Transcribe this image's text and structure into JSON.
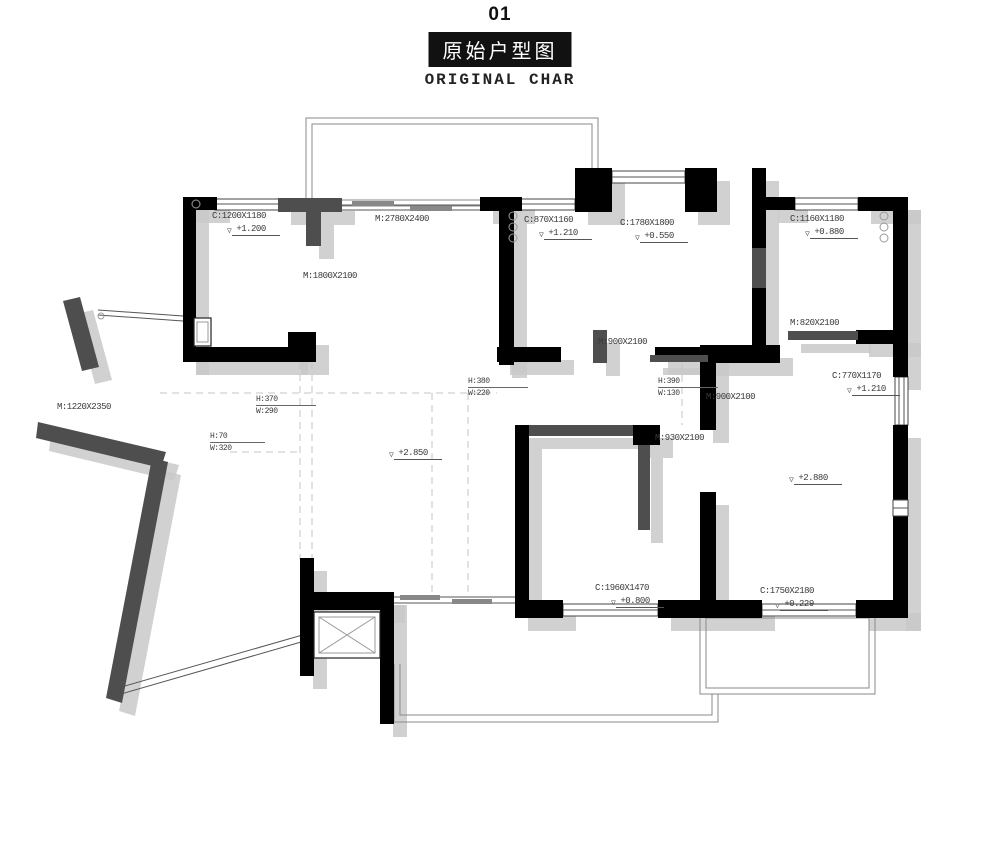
{
  "header": {
    "index": "01",
    "title_cn": "原始户型图",
    "title_en": "ORIGINAL CHAR"
  },
  "colors": {
    "wall": "#000000",
    "wall_secondary": "#4e4e4e",
    "shadow": "#c9c9c9",
    "thin_line": "#8a8a8a",
    "text": "#3a3a3a",
    "title_bg": "#111111"
  },
  "plan": {
    "labels": [
      {
        "type": "plain",
        "text": "C:1200X1180",
        "x": 212,
        "y": 211
      },
      {
        "type": "level",
        "text": "+1.200",
        "x": 228,
        "y": 224
      },
      {
        "type": "plain",
        "text": "M:2780X2400",
        "x": 375,
        "y": 214
      },
      {
        "type": "plain",
        "text": "M:1800X2100",
        "x": 303,
        "y": 271
      },
      {
        "type": "plain",
        "text": "C:870X1160",
        "x": 524,
        "y": 215
      },
      {
        "type": "level",
        "text": "+1.210",
        "x": 540,
        "y": 228
      },
      {
        "type": "plain",
        "text": "C:1780X1800",
        "x": 620,
        "y": 218
      },
      {
        "type": "level",
        "text": "+0.550",
        "x": 636,
        "y": 231
      },
      {
        "type": "plain",
        "text": "C:1160X1180",
        "x": 790,
        "y": 214
      },
      {
        "type": "level",
        "text": "+0.880",
        "x": 806,
        "y": 227
      },
      {
        "type": "plain",
        "text": "M:820X2100",
        "x": 790,
        "y": 318
      },
      {
        "type": "plain",
        "text": "M:900X2100",
        "x": 598,
        "y": 337
      },
      {
        "type": "frac",
        "top": "H:380",
        "bottom": "W:220",
        "x": 468,
        "y": 377
      },
      {
        "type": "frac",
        "top": "H:390",
        "bottom": "W:130",
        "x": 658,
        "y": 377
      },
      {
        "type": "plain",
        "text": "M:900X2100",
        "x": 706,
        "y": 392
      },
      {
        "type": "plain",
        "text": "C:770X1170",
        "x": 832,
        "y": 371
      },
      {
        "type": "level",
        "text": "+1.210",
        "x": 848,
        "y": 384
      },
      {
        "type": "plain",
        "text": "M:1220X2350",
        "x": 57,
        "y": 402
      },
      {
        "type": "frac",
        "top": "H:370",
        "bottom": "W:290",
        "x": 256,
        "y": 395
      },
      {
        "type": "frac",
        "top": "H:70",
        "bottom": "W:320",
        "x": 210,
        "y": 432
      },
      {
        "type": "level",
        "text": "+2.850",
        "x": 390,
        "y": 448
      },
      {
        "type": "plain",
        "text": "M:930X2100",
        "x": 655,
        "y": 433
      },
      {
        "type": "level",
        "text": "+2.880",
        "x": 790,
        "y": 473
      },
      {
        "type": "plain",
        "text": "C:1960X1470",
        "x": 595,
        "y": 583
      },
      {
        "type": "level",
        "text": "+0.800",
        "x": 612,
        "y": 596
      },
      {
        "type": "plain",
        "text": "C:1750X2180",
        "x": 760,
        "y": 586
      },
      {
        "type": "level",
        "text": "+0.229",
        "x": 776,
        "y": 599
      }
    ],
    "level_marker_glyph": "▽"
  }
}
